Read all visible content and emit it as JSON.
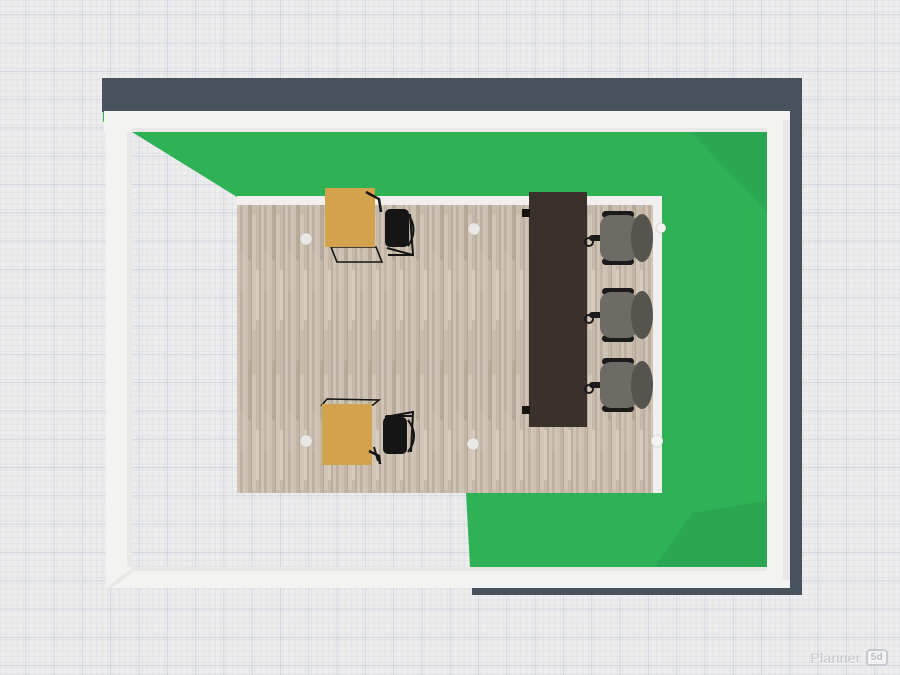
{
  "watermark": {
    "brand": "Planner",
    "badge": "5d"
  },
  "colors": {
    "canvas_bg": "#ededee",
    "grid_major": "rgba(140,155,185,0.28)",
    "grid_minor": "rgba(150,160,180,0.12)",
    "wall_dark": "#47525c",
    "wall_white": "#f3f3f2",
    "floor_green": "#2fb156",
    "floor_wood": "#c9bdae",
    "baseboard": "#f1f0ee",
    "desk_wood": "#d3a24c",
    "table_dark": "#3a312d",
    "chair_black": "#151515",
    "chair_gray_seat": "#6e6b67",
    "chair_gray_back": "#57544f",
    "light_dot": "#eae8e5"
  },
  "scene": {
    "view_label": "3d-top-view-floorplan",
    "objects": [
      {
        "name": "green-room-floor",
        "type": "room-floor",
        "color": "#2fb156"
      },
      {
        "name": "wood-office-floor",
        "type": "room-floor",
        "material": "parquet"
      },
      {
        "name": "desk-top",
        "type": "desk",
        "color": "#d3a24c"
      },
      {
        "name": "desk-bottom",
        "type": "desk",
        "color": "#d3a24c"
      },
      {
        "name": "desk-chair-top",
        "type": "chair",
        "color": "#151515"
      },
      {
        "name": "desk-chair-bottom",
        "type": "chair",
        "color": "#151515"
      },
      {
        "name": "conference-table",
        "type": "table",
        "color": "#3a312d"
      },
      {
        "name": "office-chair-1",
        "type": "office-chair",
        "color": "#6e6b67"
      },
      {
        "name": "office-chair-2",
        "type": "office-chair",
        "color": "#6e6b67"
      },
      {
        "name": "office-chair-3",
        "type": "office-chair",
        "color": "#6e6b67"
      },
      {
        "name": "ceiling-light-1",
        "type": "light"
      },
      {
        "name": "ceiling-light-2",
        "type": "light"
      },
      {
        "name": "ceiling-light-3",
        "type": "light"
      },
      {
        "name": "ceiling-light-4",
        "type": "light"
      },
      {
        "name": "wall-knob-top",
        "type": "knob"
      },
      {
        "name": "wall-knob-bottom",
        "type": "knob"
      }
    ]
  }
}
